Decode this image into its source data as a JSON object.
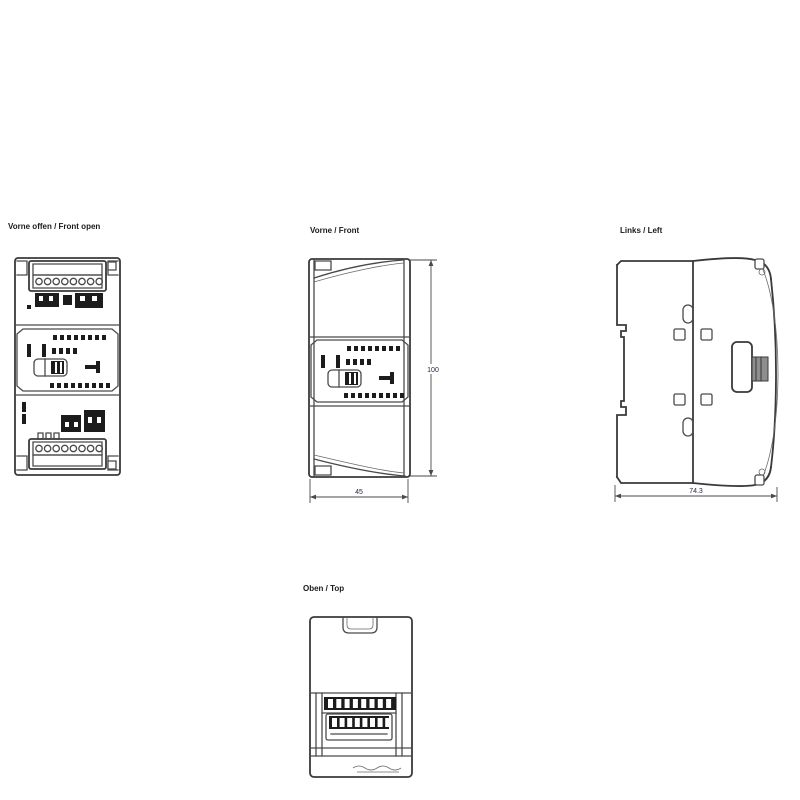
{
  "page": {
    "background": "#ffffff"
  },
  "colors": {
    "line": "#4a4a4a",
    "dark_fill": "#1c1c1c",
    "connector_gray": "#8e8e8e",
    "label_text": "#1a1a1a",
    "dimension_text": "#23283f"
  },
  "views": {
    "front_open": {
      "label": "Vorne offen / Front open"
    },
    "front": {
      "label": "Vorne / Front",
      "dimensions": {
        "height": "100",
        "width": "45"
      }
    },
    "left": {
      "label": "Links / Left",
      "dimensions": {
        "depth": "74.3"
      }
    },
    "top": {
      "label": "Oben / Top"
    }
  }
}
